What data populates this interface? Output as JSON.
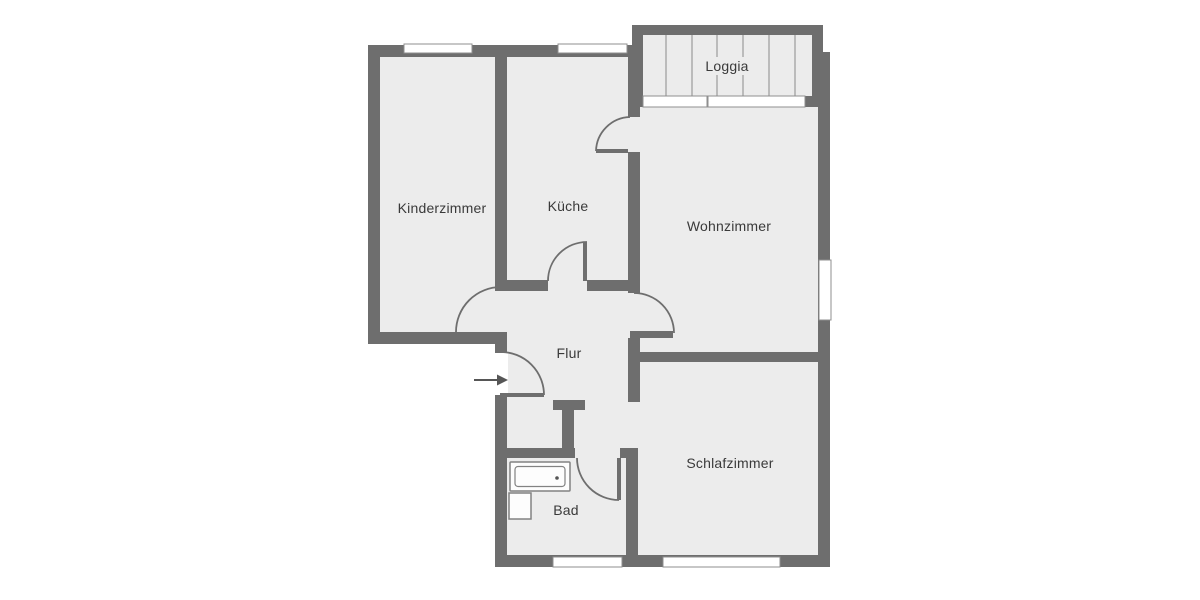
{
  "diagram": {
    "type": "apartment-floor-plan",
    "rooms": {
      "kinderzimmer": {
        "label": "Kinderzimmer"
      },
      "kueche": {
        "label": "Küche"
      },
      "wohnzimmer": {
        "label": "Wohnzimmer"
      },
      "loggia": {
        "label": "Loggia"
      },
      "flur": {
        "label": "Flur"
      },
      "bad": {
        "label": "Bad"
      },
      "schlafzimmer": {
        "label": "Schlafzimmer"
      }
    },
    "fixtures": [
      "bathtub",
      "washbasin"
    ],
    "symbols": {
      "entrance": "arrow-right"
    },
    "colors": {
      "wall": "#6e6e6e",
      "floor": "#ececec",
      "bg": "#ffffff",
      "window": "#ffffff",
      "window-frame": "#8f8f8f",
      "door": "#6e6e6e",
      "text": "#3a3a3a"
    }
  }
}
